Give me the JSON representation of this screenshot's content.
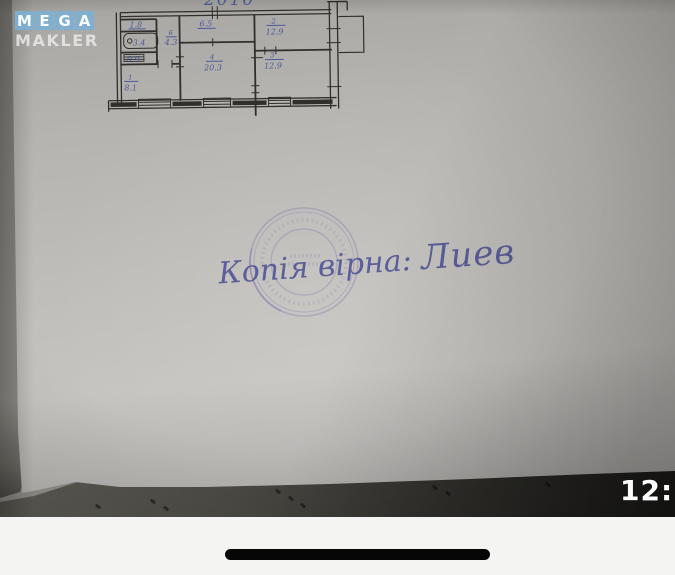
{
  "watermark": {
    "mega_letters": [
      "M",
      "E",
      "G",
      "A"
    ],
    "makler": "MAKLER"
  },
  "photo": {
    "year_note": "2010",
    "certification_text": "Копія вірна:",
    "signature": "Лиев",
    "floorplan": {
      "rooms": {
        "closet": {
          "area": "1.8"
        },
        "bath": {
          "area": "3.4"
        },
        "wc": {
          "area": "0.9"
        },
        "hall": {
          "num": "6",
          "area": "4.3"
        },
        "kitchen": {
          "area": "6.5"
        },
        "living": {
          "num": "4",
          "area": "20.3"
        },
        "room2": {
          "num": "2",
          "area": "12.9"
        },
        "room3": {
          "num": "3",
          "area": "12.9"
        },
        "room1": {
          "num": "1",
          "area": "8.1"
        }
      }
    }
  },
  "system": {
    "clock": "12:"
  },
  "colors": {
    "logo_blue": "#7ab0d6",
    "ink_blue": "#3f4d9c",
    "stamp_purple": "#8a77ad",
    "handwriting_blue": "#525696",
    "plan_ink": "#302f2b"
  }
}
